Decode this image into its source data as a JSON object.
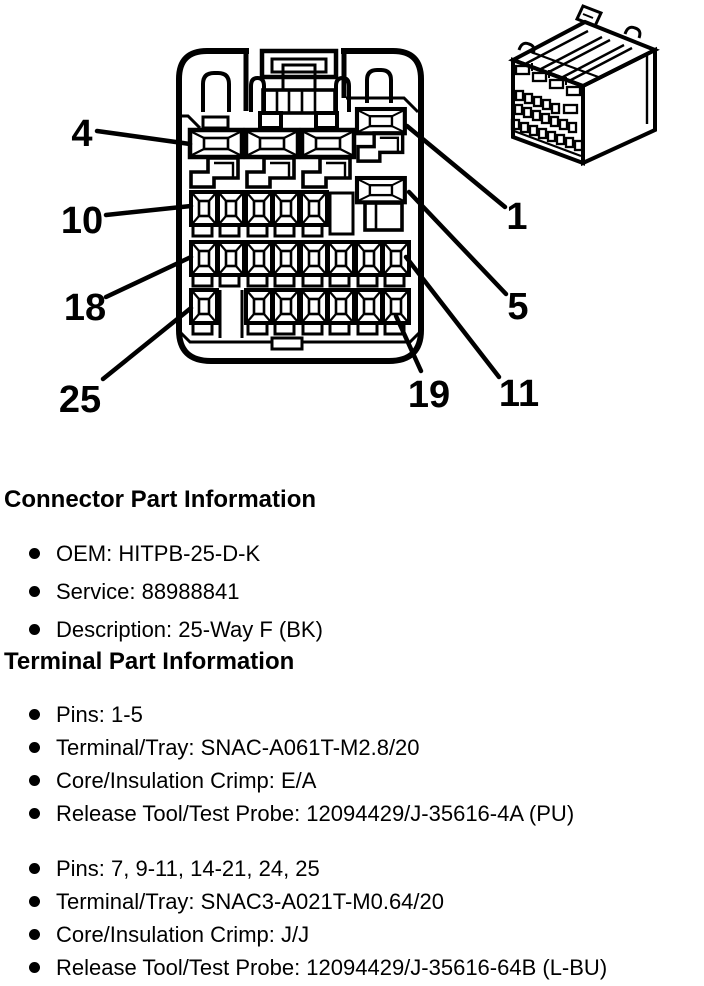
{
  "diagram": {
    "callouts": {
      "c4": "4",
      "c10": "10",
      "c18": "18",
      "c25": "25",
      "c1": "1",
      "c5": "5",
      "c19": "19",
      "c11": "11"
    }
  },
  "sections": {
    "connector": {
      "heading": "Connector Part Information",
      "items": [
        "OEM: HITPB-25-D-K",
        "Service: 88988841",
        "Description: 25-Way F (BK)"
      ]
    },
    "terminal": {
      "heading": "Terminal Part Information",
      "groups": [
        {
          "items": [
            "Pins: 1-5",
            "Terminal/Tray: SNAC-A061T-M2.8/20",
            "Core/Insulation Crimp: E/A",
            "Release Tool/Test Probe: 12094429/J-35616-4A (PU)"
          ]
        },
        {
          "items": [
            "Pins: 7, 9-11, 14-21, 24, 25",
            "Terminal/Tray: SNAC3-A021T-M0.64/20",
            "Core/Insulation Crimp: J/J",
            "Release Tool/Test Probe: 12094429/J-35616-64B (L-BU)"
          ]
        }
      ]
    }
  }
}
